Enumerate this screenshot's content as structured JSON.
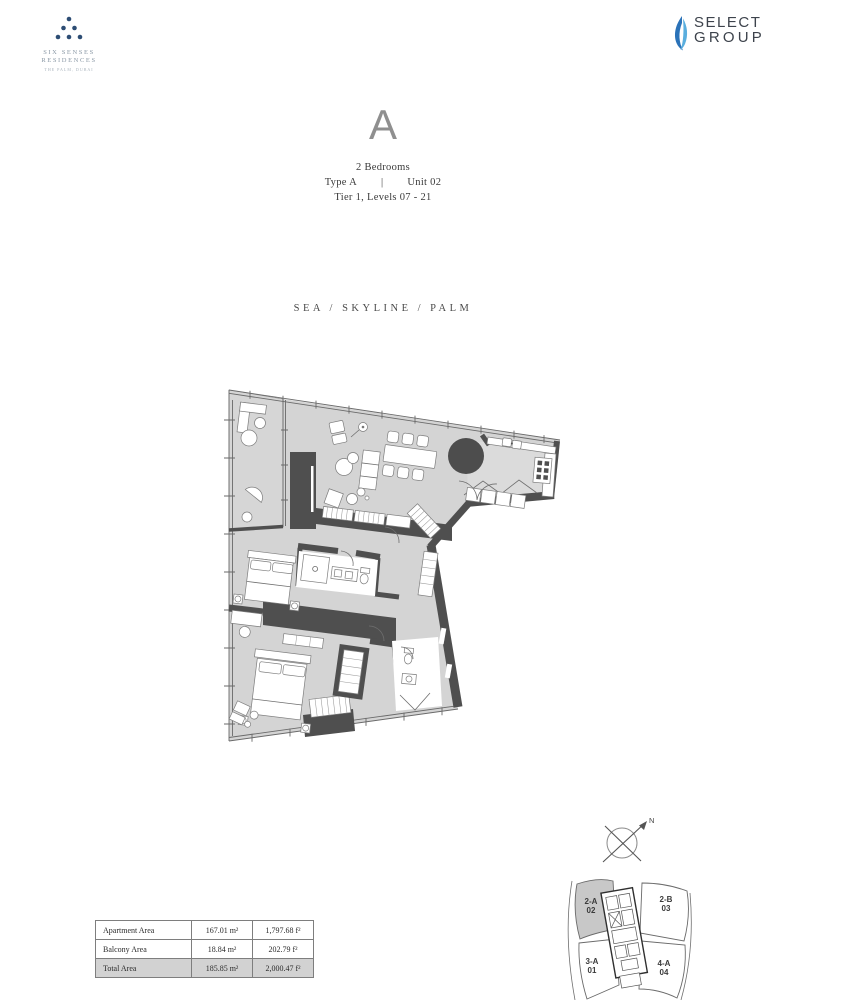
{
  "brand": {
    "residences": {
      "name_line1": "SIX SENSES",
      "name_line2": "RESIDENCES",
      "tagline": "THE PALM, DUBAI"
    },
    "developer": {
      "name_line1": "SELECT",
      "name_line2": "GROUP"
    }
  },
  "header": {
    "plan_letter": "A",
    "bedrooms": "2 Bedrooms",
    "type": "Type A",
    "separator": "|",
    "unit": "Unit 02",
    "tier": "Tier 1, Levels 07 - 21"
  },
  "views": {
    "label": "SEA / SKYLINE / PALM"
  },
  "area_table": {
    "rows": [
      {
        "label": "Apartment Area",
        "metric": "167.01 m²",
        "imperial": "1,797.68 f²"
      },
      {
        "label": "Balcony Area",
        "metric": "18.84 m²",
        "imperial": "202.79 f²"
      },
      {
        "label": "Total Area",
        "metric": "185.85 m²",
        "imperial": "2,000.47 f²"
      }
    ]
  },
  "key_plan": {
    "compass_label": "N",
    "units": [
      {
        "code": "2-A",
        "number": "02",
        "highlighted": true
      },
      {
        "code": "2-B",
        "number": "03",
        "highlighted": false
      },
      {
        "code": "3-A",
        "number": "01",
        "highlighted": false
      },
      {
        "code": "4-A",
        "number": "04",
        "highlighted": false
      }
    ]
  },
  "colors": {
    "wall": "#4f4f4f",
    "floor": "#d4d4d4",
    "kitchen_floor": "#dbdbdb",
    "highlight_unit_fill": "#c8c8c8",
    "brand_blue": "#2d4d74",
    "flame_blue": "#2a72b8",
    "flame_light": "#5aaede",
    "title_gray": "#8f8f8f",
    "total_row_bg": "#d2d2d2"
  }
}
